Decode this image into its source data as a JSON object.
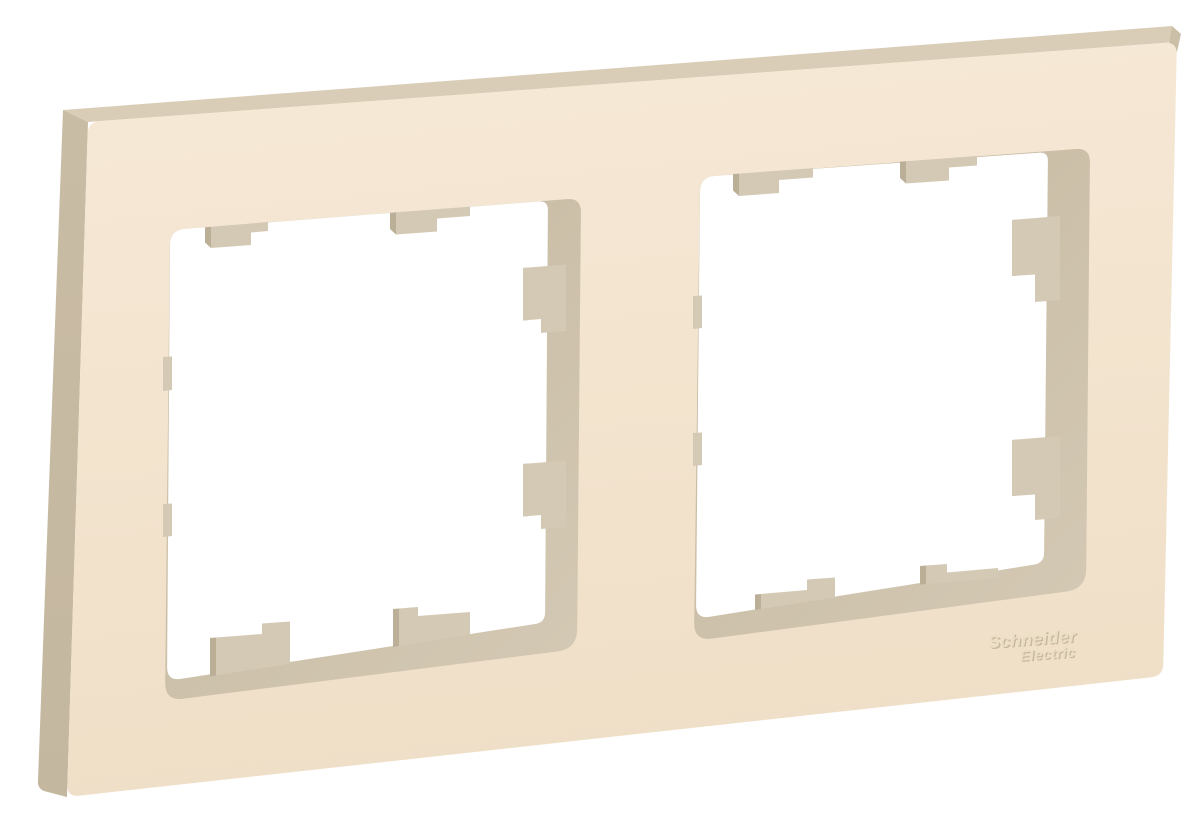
{
  "background_color": "#ffffff",
  "logo": {
    "line1": "Schneider",
    "line2": "Electric"
  },
  "product": {
    "openings_count": 2,
    "mounting_tabs_per_opening": 8,
    "colors": {
      "face_light": "#f6e9d7",
      "face_dark": "#f0dfc7",
      "side_left": "#c9bca5",
      "side_top": "#dacdb7",
      "side_corner": "#cbbfa8",
      "wall_light": "#d3c8b3",
      "wall_dark": "#c4b79f",
      "opening_fill": "#ffffff",
      "tab_face": "#d4c9b4",
      "tab_edge": "#bbaf97",
      "emboss_dark": "#c7b79b",
      "emboss_light": "#eaddc6"
    }
  }
}
